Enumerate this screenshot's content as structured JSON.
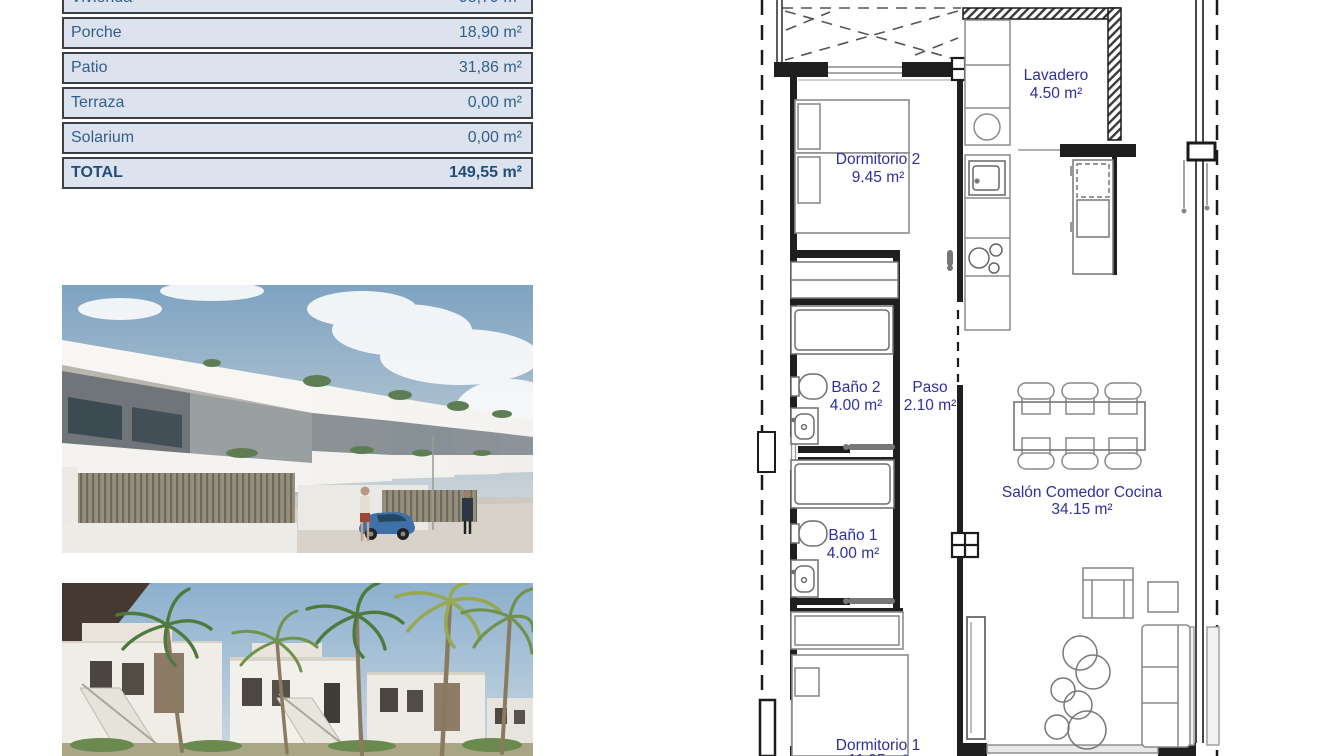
{
  "area_table": {
    "rows": [
      {
        "label": "Vivienda",
        "value": "98,79 m²"
      },
      {
        "label": "Porche",
        "value": "18,90 m²"
      },
      {
        "label": "Patio",
        "value": "31,86 m²"
      },
      {
        "label": "Terraza",
        "value": "0,00 m²"
      },
      {
        "label": "Solarium",
        "value": "0,00 m²"
      }
    ],
    "total": {
      "label": "TOTAL",
      "value": "149,55 m²"
    },
    "colors": {
      "row_bg": "#dce3ee",
      "text": "#30608a",
      "total_text": "#1f4e79",
      "border": "#3b3f46"
    }
  },
  "floor_plan": {
    "rooms": [
      {
        "name": "Dormitorio 2",
        "area": "9.45 m²"
      },
      {
        "name": "Lavadero",
        "area": "4.50 m²"
      },
      {
        "name": "Baño 2",
        "area": "4.00 m²"
      },
      {
        "name": "Paso",
        "area": "2.10 m²"
      },
      {
        "name": "Baño 1",
        "area": "4.00 m²"
      },
      {
        "name": "Salón Comedor Cocina",
        "area": "34.15 m²"
      },
      {
        "name": "Dormitorio 1",
        "area": "11.95 m²"
      }
    ],
    "label_color": "#2d309c"
  }
}
